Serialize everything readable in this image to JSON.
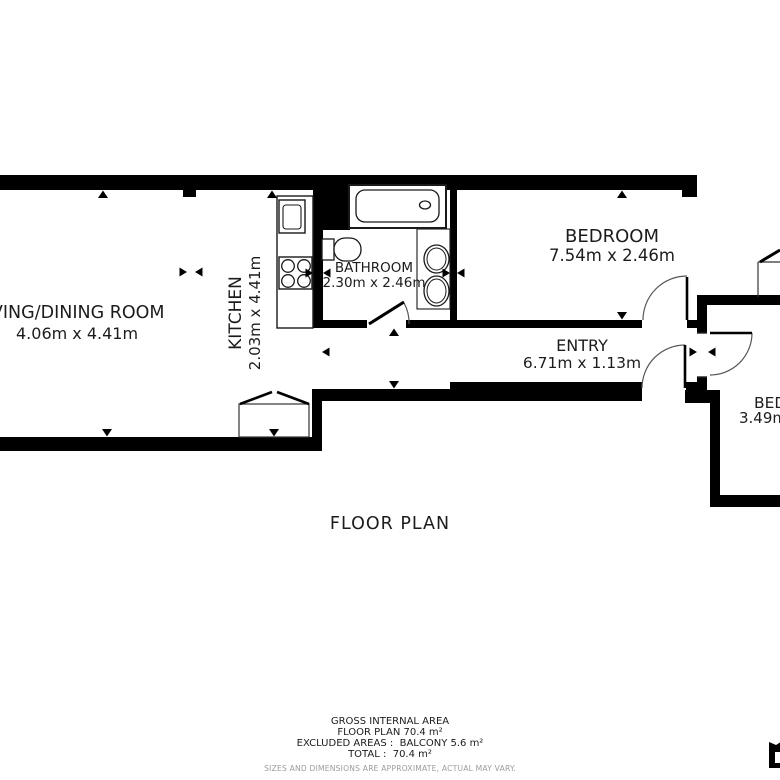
{
  "title": "FLOOR PLAN",
  "colors": {
    "wall": "#000000",
    "text": "#1c1c1c",
    "muted": "#9b9b9b",
    "background": "#ffffff"
  },
  "rooms": {
    "living": {
      "name": "LIVING/DINING ROOM",
      "dims": "4.06m x 4.41m"
    },
    "kitchen": {
      "name": "KITCHEN",
      "dims": "2.03m x 4.41m"
    },
    "bathroom": {
      "name": "BATHROOM",
      "dims": "2.30m x 2.46m"
    },
    "bedroom1": {
      "name": "BEDROOM",
      "dims": "7.54m x 2.46m"
    },
    "entry": {
      "name": "ENTRY",
      "dims": "6.71m x 1.13m"
    },
    "bedroom2": {
      "name": "BEDROOM",
      "dims": "3.49m x"
    }
  },
  "footer": {
    "line1": "GROSS INTERNAL AREA",
    "line2": "FLOOR PLAN 70.4 m²",
    "line3": "EXCLUDED AREAS :  BALCONY 5.6 m²",
    "line4": "TOTAL :  70.4 m²",
    "disclaimer": "SIZES AND DIMENSIONS ARE APPROXIMATE, ACTUAL MAY VARY."
  }
}
